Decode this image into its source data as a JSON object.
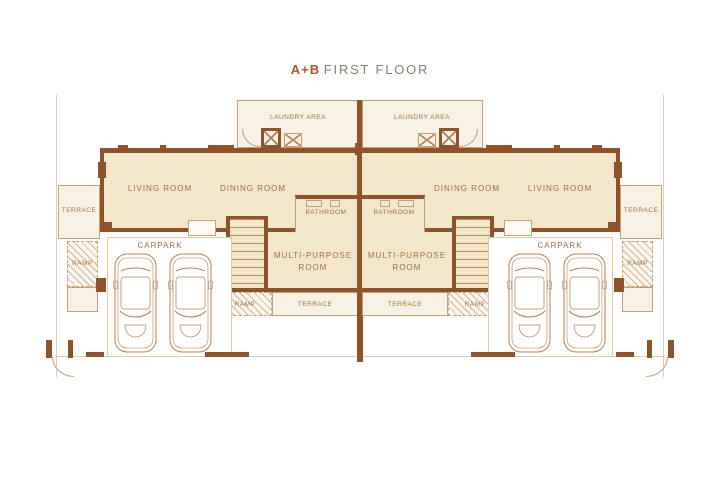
{
  "title": {
    "code": "A+B",
    "name": "FIRST FLOOR"
  },
  "rooms": {
    "laundry_area": "LAUNDRY AREA",
    "living_room": "LIVING ROOM",
    "dining_room": "DINING ROOM",
    "bathroom": "BATHROOM",
    "multi_purpose_room": "MULTI-PURPOSE ROOM",
    "terrace": "TERRACE",
    "ramp": "RAMP",
    "carpark": "CARPARK"
  },
  "colors": {
    "wall": "#8e5329",
    "floor": "#f2e7c8",
    "floor_light": "#f7f2e3",
    "outline": "#c4a178",
    "label": "#9e6f42",
    "accent": "#b2552b",
    "title_gray": "#8a7d6f",
    "boundary": "#d8cfbd",
    "car_line": "#b08054"
  }
}
